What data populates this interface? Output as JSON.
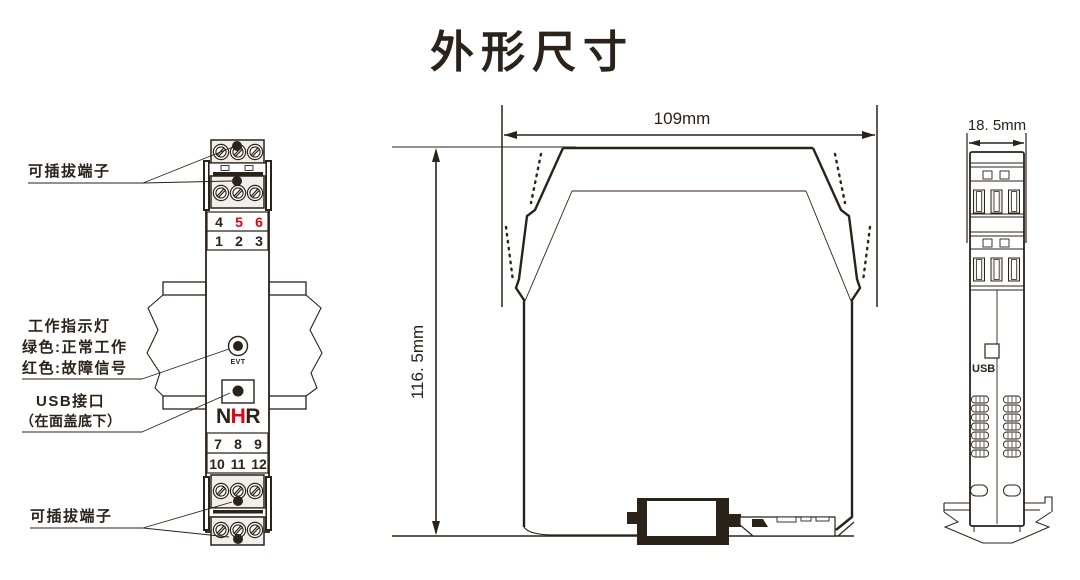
{
  "title": "外形尺寸",
  "colors": {
    "line": "#2b2219",
    "red": "#e60012"
  },
  "front_view": {
    "label_terminal_top": "可插拔端子",
    "label_indicator": [
      "工作指示灯",
      "绿色:正常工作",
      "红色:故障信号"
    ],
    "label_usb": [
      "USB接口",
      "（在面盖底下）"
    ],
    "label_terminal_bottom": "可插拔端子",
    "led_label": "EVT",
    "logo": [
      "N",
      "H",
      "R"
    ],
    "terminals": {
      "row1": [
        "4",
        "5",
        "6"
      ],
      "row2": [
        "1",
        "2",
        "3"
      ],
      "row3": [
        "7",
        "8",
        "9"
      ],
      "row4": [
        "10",
        "11",
        "12"
      ]
    }
  },
  "side_view": {
    "width_label": "109mm",
    "height_label": "116. 5mm"
  },
  "end_view": {
    "width_label": "18. 5mm",
    "usb_label": "USB"
  }
}
